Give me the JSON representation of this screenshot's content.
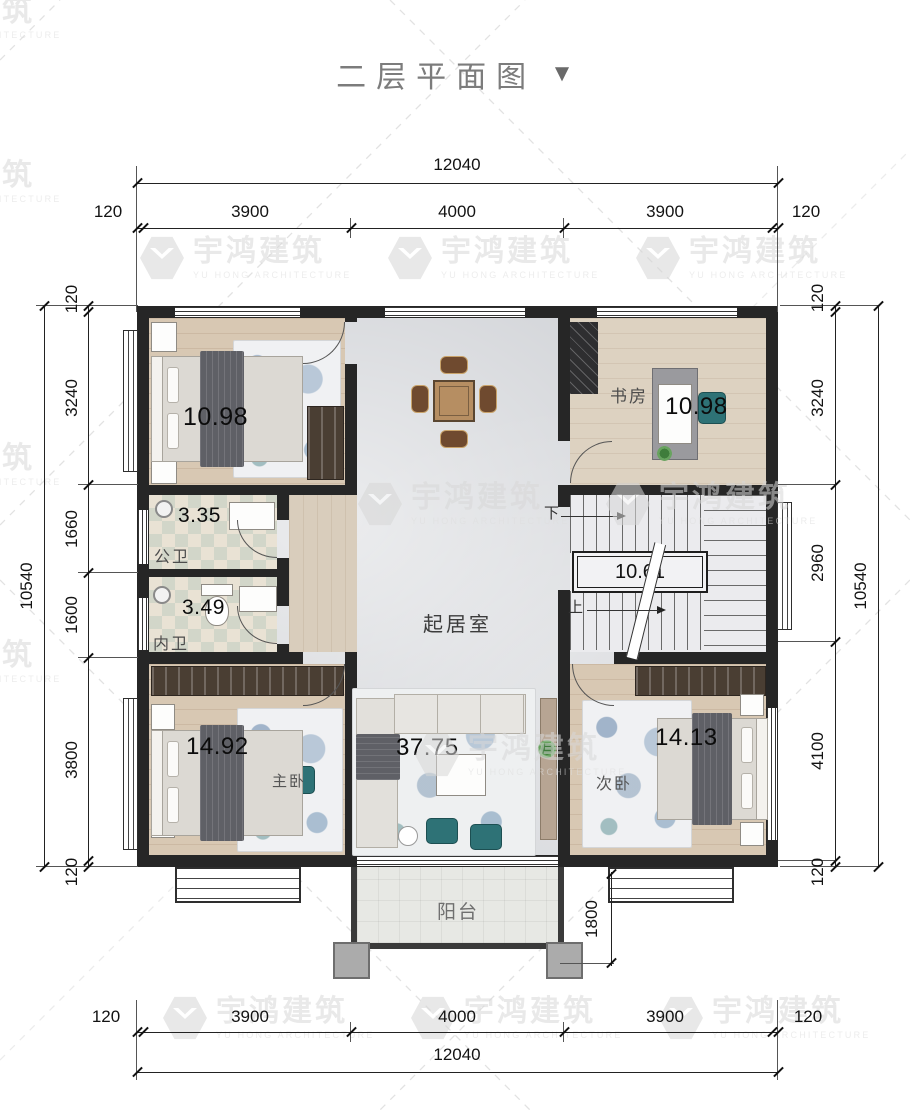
{
  "title": {
    "text": "二层平面图",
    "arrow": "▼"
  },
  "watermark": {
    "cn": "宇鸿建筑",
    "en": "YU HONG ARCHITECTURE"
  },
  "dimensions": {
    "top": {
      "total": "12040",
      "segments": [
        "120",
        "3900",
        "4000",
        "3900",
        "120"
      ]
    },
    "bottom": {
      "total": "12040",
      "segments": [
        "120",
        "3900",
        "4000",
        "3900",
        "120"
      ]
    },
    "left": {
      "total": "10540",
      "segments": [
        "120",
        "3240",
        "1660",
        "1600",
        "3800",
        "120"
      ]
    },
    "right": {
      "total": "10540",
      "segments": [
        "120",
        "3240",
        "2960",
        "4100",
        "120"
      ]
    },
    "balcony_depth": "1800"
  },
  "rooms": {
    "bedroom_top_left": {
      "area": "10.98"
    },
    "study": {
      "name": "书房",
      "area": "10.98"
    },
    "bath_public": {
      "name": "公卫",
      "area": "3.35"
    },
    "bath_inner": {
      "name": "内卫",
      "area": "3.49"
    },
    "living": {
      "name": "起居室",
      "area": "37.75"
    },
    "stairs": {
      "area": "10.61",
      "up": "上",
      "down": "下"
    },
    "master": {
      "name": "主卧",
      "area": "14.92"
    },
    "bedroom_second": {
      "name": "次卧",
      "area": "14.13"
    },
    "balcony": {
      "name": "阳台"
    }
  }
}
